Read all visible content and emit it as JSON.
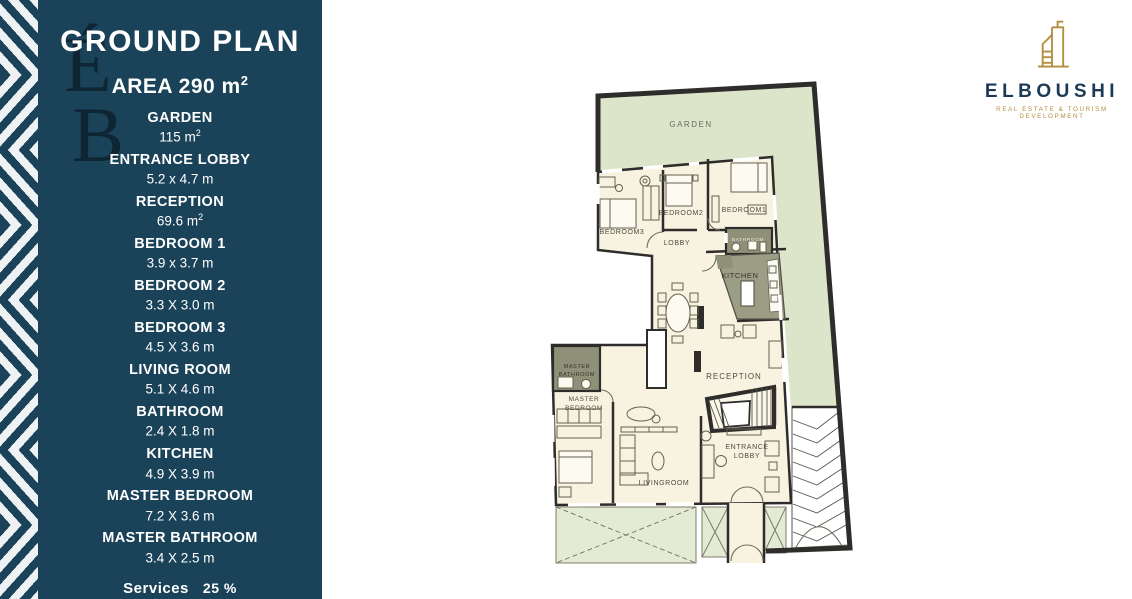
{
  "sidebar": {
    "title": "GROUND PLAN",
    "area_label": "AREA 290 m",
    "area_sup": "2",
    "items": [
      {
        "name": "GARDEN",
        "value": "115 m",
        "sup": "2"
      },
      {
        "name": "ENTRANCE LOBBY",
        "value": "5.2 x 4.7 m"
      },
      {
        "name": "RECEPTION",
        "value": "69.6 m",
        "sup": "2"
      },
      {
        "name": "BEDROOM 1",
        "value": "3.9 x 3.7 m"
      },
      {
        "name": "BEDROOM 2",
        "value": "3.3 X 3.0 m"
      },
      {
        "name": "BEDROOM 3",
        "value": "4.5 X 3.6 m"
      },
      {
        "name": "LIVING ROOM",
        "value": "5.1 X 4.6 m"
      },
      {
        "name": "BATHROOM",
        "value": "2.4 X 1.8 m"
      },
      {
        "name": "KITCHEN",
        "value": "4.9 X 3.9 m"
      },
      {
        "name": "MASTER BEDROOM",
        "value": "7.2 X 3.6 m"
      },
      {
        "name": "MASTER BATHROOM",
        "value": "3.4 X 2.5 m"
      }
    ],
    "services_label": "Services",
    "services_value": "25 %"
  },
  "watermark": {
    "line1": "É",
    "line2": "B"
  },
  "plan": {
    "rooms": {
      "garden": "GARDEN",
      "bedroom3": "BEDROOM3",
      "bedroom2": "BEDROOM2",
      "bedroom1": "BEDROOM1",
      "lobby": "LOBBY",
      "bathroom": "BATHROOM",
      "kitchen": "KITCHEN",
      "reception": "RECEPTION",
      "master_bathroom": [
        "MASTER",
        "BATHROOM"
      ],
      "master_bedroom": [
        "MASTER",
        "BEDROOM"
      ],
      "livingroom": "LIVINGROOM",
      "entrance_lobby": [
        "ENTRANCE",
        "LOBBY"
      ]
    }
  },
  "logo": {
    "name": "ELBOUSHI",
    "tagline": "REAL ESTATE & TOURISM DEVELOPMENT"
  },
  "colors": {
    "sidebar_navy": "#1a4258",
    "garden_green": "#dce4c9",
    "floor_cream": "#f8f3e0",
    "counter_olive": "#8e9077",
    "wall_dark": "#2e2d2b",
    "logo_gold": "#b28f3e",
    "logo_navy": "#1c3a56"
  }
}
